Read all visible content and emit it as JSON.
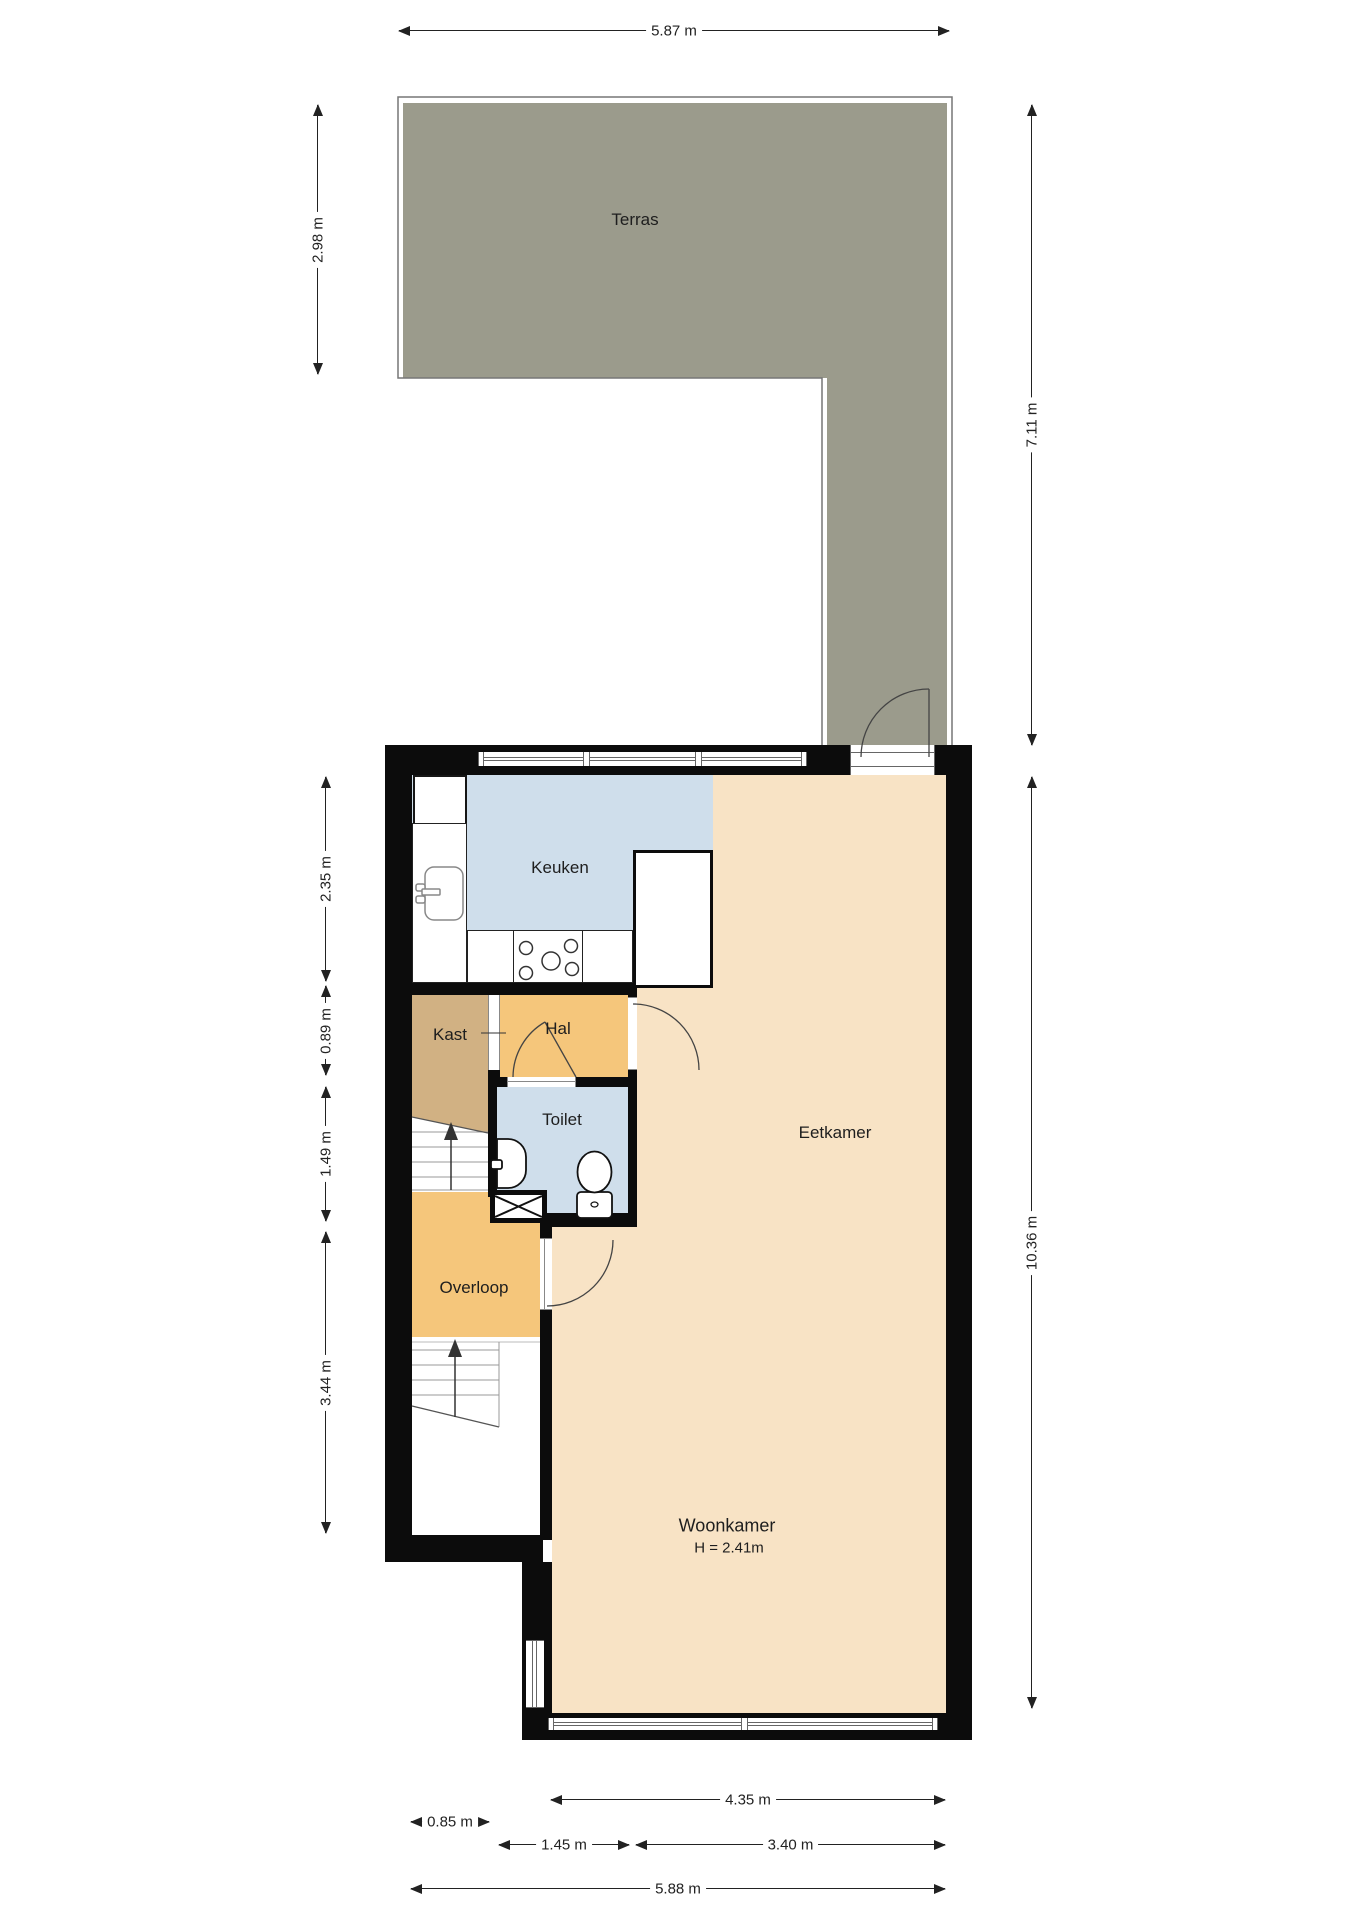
{
  "plan": {
    "rooms": {
      "terras": "Terras",
      "keuken": "Keuken",
      "kast": "Kast",
      "hal": "Hal",
      "toilet": "Toilet",
      "eetkamer": "Eetkamer",
      "overloop": "Overloop",
      "woonkamer": "Woonkamer",
      "woonkamer_height": "H = 2.41m"
    },
    "dimensions": {
      "horizontal": [
        {
          "label": "5.87 m",
          "x1": 398,
          "x2": 950,
          "y": 31
        },
        {
          "label": "4.35 m",
          "x1": 550,
          "x2": 946,
          "y": 1800
        },
        {
          "label": "0.85 m",
          "x1": 410,
          "x2": 490,
          "y": 1822
        },
        {
          "label": "1.45 m",
          "x1": 498,
          "x2": 630,
          "y": 1845
        },
        {
          "label": "3.40 m",
          "x1": 635,
          "x2": 946,
          "y": 1845
        },
        {
          "label": "5.88 m",
          "x1": 410,
          "x2": 946,
          "y": 1889
        }
      ],
      "vertical": [
        {
          "label": "2.98 m",
          "y1": 104,
          "y2": 375,
          "x": 318
        },
        {
          "label": "2.35 m",
          "y1": 776,
          "y2": 982,
          "x": 326
        },
        {
          "label": "0.89 m",
          "y1": 985,
          "y2": 1076,
          "x": 326
        },
        {
          "label": "1.49 m",
          "y1": 1086,
          "y2": 1222,
          "x": 326
        },
        {
          "label": "3.44 m",
          "y1": 1231,
          "y2": 1534,
          "x": 326
        },
        {
          "label": "7.11 m",
          "y1": 104,
          "y2": 746,
          "x": 1032
        },
        {
          "label": "10.36 m",
          "y1": 776,
          "y2": 1709,
          "x": 1032
        }
      ]
    },
    "colors": {
      "terrace": "#9b9b8c",
      "kitchen_toilet": "#cfdeeb",
      "living": "#f8e3c5",
      "hallway": "#f5c67b",
      "closet": "#d1b183",
      "wall": "#0c0c0c",
      "dimension_text": "#222222"
    }
  }
}
